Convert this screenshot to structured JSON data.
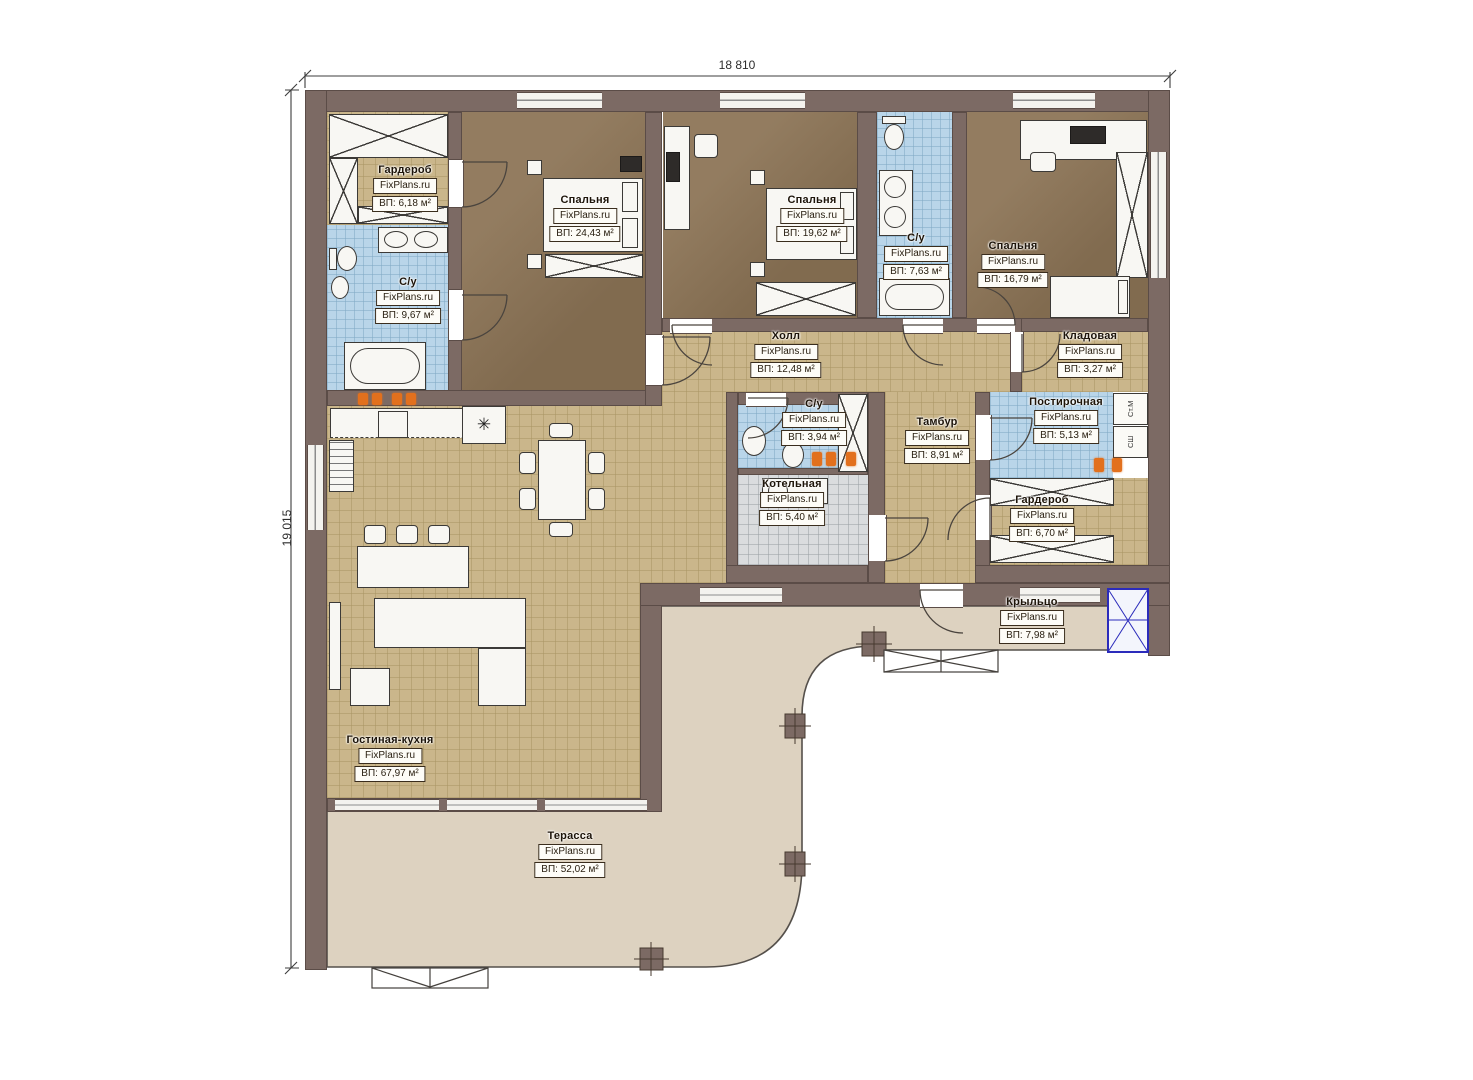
{
  "watermark": "FixPlans.ru",
  "dimensions": {
    "top": "18 810",
    "left": "19 015"
  },
  "rooms": {
    "garderob1": {
      "name": "Гардероб",
      "area": "ВП: 6,18 м²"
    },
    "su1": {
      "name": "С/у",
      "area": "ВП: 9,67 м²"
    },
    "bedroom1": {
      "name": "Спальня",
      "area": "ВП: 24,43 м²"
    },
    "bedroom2": {
      "name": "Спальня",
      "area": "ВП: 19,62 м²"
    },
    "su2": {
      "name": "С/у",
      "area": "ВП: 7,63 м²"
    },
    "bedroom3": {
      "name": "Спальня",
      "area": "ВП: 16,79 м²"
    },
    "hall": {
      "name": "Холл",
      "area": "ВП: 12,48 м²"
    },
    "kladovaya": {
      "name": "Кладовая",
      "area": "ВП: 3,27 м²"
    },
    "su3": {
      "name": "С/у",
      "area": "ВП: 3,94 м²"
    },
    "kotelnaya": {
      "name": "Котельная",
      "area": "ВП: 5,40 м²"
    },
    "tambur": {
      "name": "Тамбур",
      "area": "ВП: 8,91 м²"
    },
    "postirochnaya": {
      "name": "Постирочная",
      "area": "ВП: 5,13 м²"
    },
    "garderob2": {
      "name": "Гардероб",
      "area": "ВП: 6,70 м²"
    },
    "krylco": {
      "name": "Крыльцо",
      "area": "ВП: 7,98 м²"
    },
    "livingkitchen": {
      "name": "Гостиная-кухня",
      "area": "ВП: 67,97 м²"
    },
    "terrace": {
      "name": "Терасса",
      "area": "ВП: 52,02 м²"
    }
  },
  "appliances": {
    "washing_machine": "Ст.М",
    "drying_cabinet": "СШ"
  },
  "symbols": {
    "cooker_hood": "✳"
  },
  "colors": {
    "wall": "#7c6a64",
    "wallEdge": "#5b4c47",
    "tan": "#cab68b",
    "tanLine": "#a8946388",
    "blue": "#b9d5e9",
    "blueLine": "#7fa8c488",
    "brown": "#8c7456",
    "gray": "#dadcde",
    "grayLine": "#9aa0a488",
    "terrace": "#ddd2c0",
    "orange": "#e2701d",
    "accent": "#2b2bbb",
    "line": "#4a443e"
  }
}
